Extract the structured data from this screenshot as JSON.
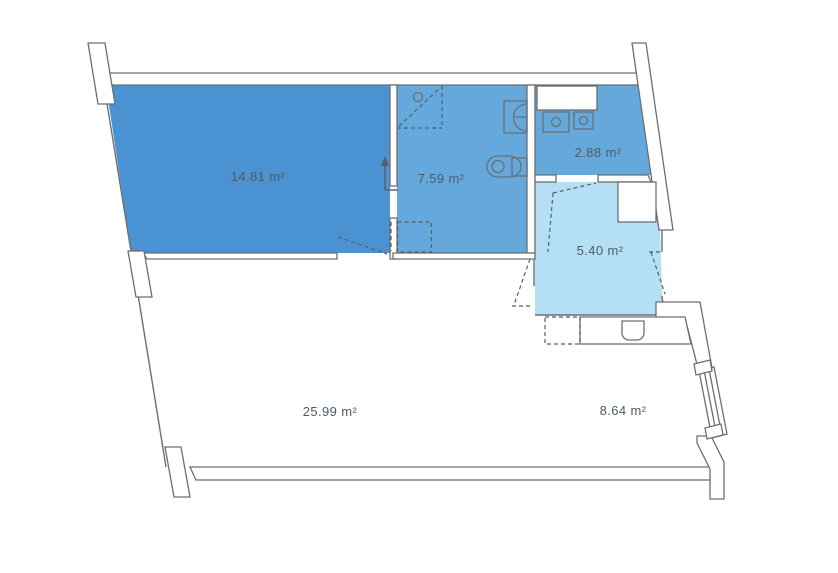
{
  "diagram": {
    "type": "floor-plan",
    "unit": "m²",
    "rooms": [
      {
        "id": "room-large-blue",
        "label": "14.81 m²",
        "area": 14.81,
        "fill": "#4a92d2"
      },
      {
        "id": "room-bathroom",
        "label": "7.59 m²",
        "area": 7.59,
        "fill": "#65a9dc"
      },
      {
        "id": "room-utility",
        "label": "2.88 m²",
        "area": 2.88,
        "fill": "#65a9dc"
      },
      {
        "id": "room-hallway",
        "label": "5.40 m²",
        "area": 5.4,
        "fill": "#b4dff5"
      },
      {
        "id": "room-living",
        "label": "25.99 m²",
        "area": 25.99,
        "fill": "#ffffff"
      },
      {
        "id": "room-kitchen-area",
        "label": "8.64 m²",
        "area": 8.64,
        "fill": "#ffffff"
      }
    ],
    "fixtures": [
      "shower",
      "washbasin",
      "toilet",
      "washer",
      "dryer",
      "utility-counter",
      "closet",
      "kitchen-counter",
      "kitchen-sink",
      "appliance-space"
    ],
    "colors": {
      "wall_stroke": "#6e6e6e",
      "wall_fill": "#ffffff",
      "fixture_stroke": "#6a6f73",
      "dash_stroke": "#555f66",
      "label_color": "#4e5c66"
    }
  }
}
